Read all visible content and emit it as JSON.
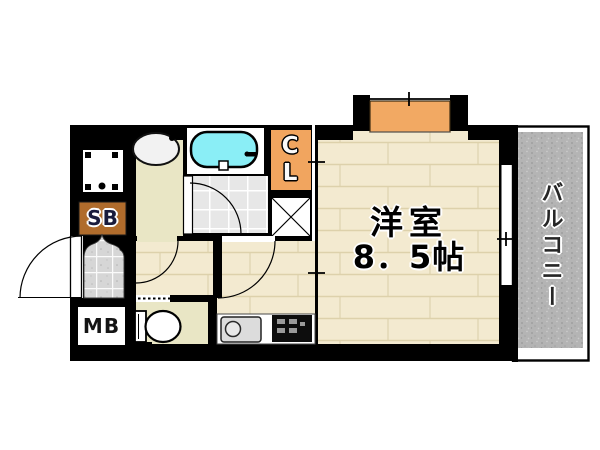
{
  "floor_plan": {
    "main_room": {
      "name": "洋室",
      "size": "8．5帖"
    },
    "balcony": {
      "label": "バルコニー"
    },
    "closet": {
      "label": "CL"
    },
    "shoe_box": {
      "label": "SB"
    },
    "meter_box": {
      "label": "MB"
    },
    "colors": {
      "wall": "#000000",
      "wood_floor": "#f3ead0",
      "bathtub_cyan": "#8aeef6",
      "closet_orange": "#f1a55f",
      "window_bay_orange": "#f2a963",
      "shoe_box_brown": "#b06c2c",
      "balcony_gray": "#b4b4b4",
      "entrance_tile_gray": "#d6d6d6",
      "service_floor_khaki": "#e9e6c5"
    }
  }
}
